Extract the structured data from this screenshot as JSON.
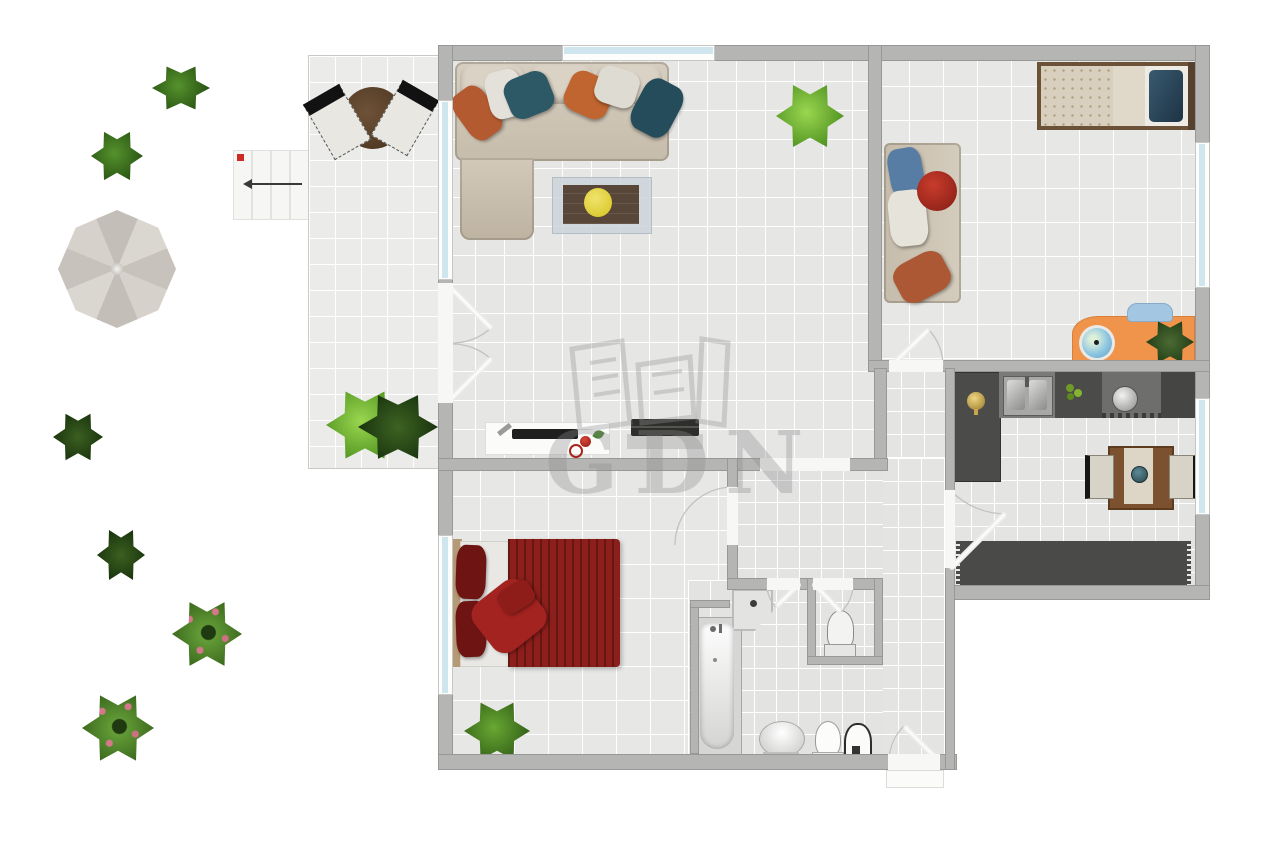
{
  "watermark": {
    "text": "GDN",
    "logo": "building-outline-icon"
  },
  "palette": {
    "background": "#ffffff",
    "wall": "#b5b5b4",
    "floor_tile": "#e6e6e5",
    "terrace_tile": "#ebebea",
    "window_glass": "#cfe6ef",
    "sofa_beige": "#d1c8b9",
    "pillow_teal": "#2d5866",
    "pillow_orange": "#bf5c2e",
    "bed_blanket_red": "#8d1f1b",
    "desk_orange": "#f0944b",
    "kitchen_counter_dark": "#4b4b49",
    "wood_brown": "#7b5130",
    "plant_green": "#5a9630",
    "stairs_marker_red": "#cc2a22"
  },
  "garden": {
    "items": [
      "bush",
      "bush",
      "parasol-umbrella",
      "stairs",
      "palm-plant",
      "palm-plant",
      "flower-bush",
      "flower-bush"
    ],
    "stairs": {
      "steps": 4,
      "arrow_direction": "left"
    }
  },
  "terrace": {
    "items": [
      "round-table",
      "chair",
      "chair",
      "fern-plant",
      "palm-plant"
    ]
  },
  "living_room": {
    "items": [
      "corner-sofa",
      "throw-pillows",
      "coffee-table",
      "potted-plant",
      "tv-lowboard",
      "remote-control",
      "tv",
      "media-console"
    ]
  },
  "kids_room": {
    "items": [
      "single-bed",
      "sofa",
      "round-pillow",
      "orange-desk",
      "desk-chair",
      "globe",
      "potted-plant"
    ]
  },
  "kitchen": {
    "items": [
      "corner-counter",
      "double-sink",
      "vegetables",
      "pot-on-hob",
      "counter",
      "dining-table",
      "chair",
      "chair",
      "rug"
    ]
  },
  "bedroom": {
    "items": [
      "double-bed",
      "red-pillows",
      "potted-plant"
    ]
  },
  "bathroom": {
    "items": [
      "bathtub",
      "corner-shower",
      "washbasin",
      "toilet",
      "water-heater"
    ]
  },
  "wc": {
    "items": [
      "toilet"
    ]
  }
}
